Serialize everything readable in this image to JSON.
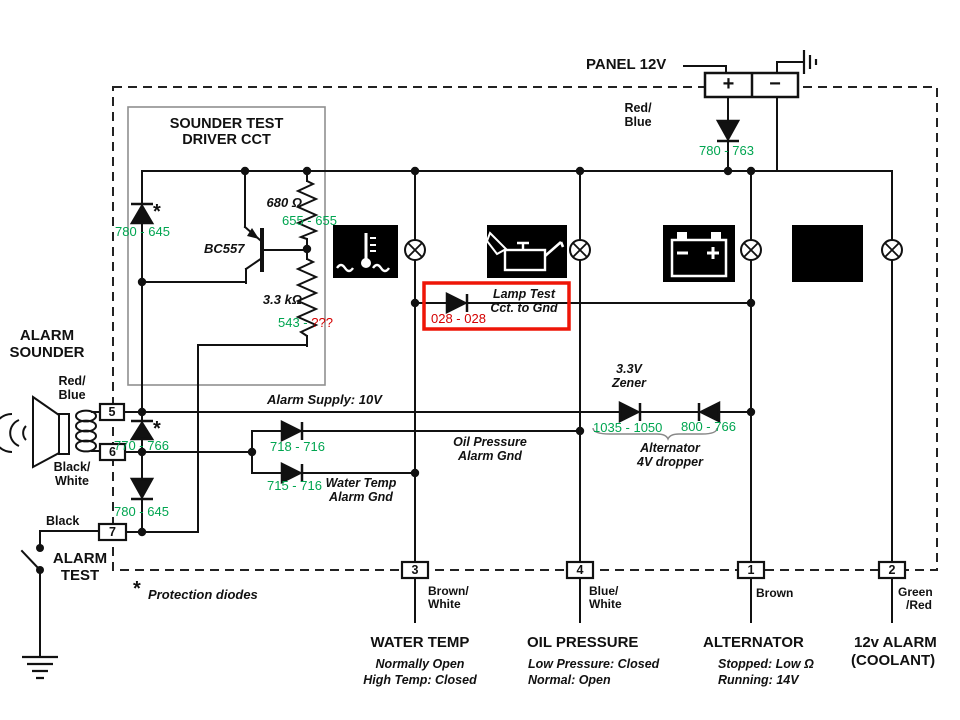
{
  "colors": {
    "annotation_green": "#00a550",
    "annotation_red": "#d40000",
    "highlight_red": "#ee1507",
    "wire_black": "#111111"
  },
  "panel": {
    "title": "PANEL 12V",
    "plus": "+",
    "minus": "−",
    "wire_color_1": "Red/",
    "wire_color_2": "Blue"
  },
  "sounder_test_box": {
    "title_1": "SOUNDER TEST",
    "title_2": "DRIVER CCT",
    "resistor_top": "680 Ω",
    "resistor_bottom": "3.3 kΩ",
    "transistor": "BC557",
    "protection_star": "*"
  },
  "alarm_sounder": {
    "title_1": "ALARM",
    "title_2": "SOUNDER",
    "wire_top_1": "Red/",
    "wire_top_2": "Blue",
    "wire_bottom_1": "Black/",
    "wire_bottom_2": "White"
  },
  "alarm_test": {
    "wire_color": "Black",
    "label_1": "ALARM",
    "label_2": "TEST"
  },
  "footnote": {
    "star": "*",
    "text": "Protection diodes"
  },
  "net_labels": {
    "alarm_supply": "Alarm Supply: 10V",
    "oil_pressure_gnd_1": "Oil Pressure",
    "oil_pressure_gnd_2": "Alarm Gnd",
    "water_temp_gnd_1": "Water Temp",
    "water_temp_gnd_2": "Alarm Gnd",
    "zener_1": "3.3V",
    "zener_2": "Zener",
    "dropper_1": "Alternator",
    "dropper_2": "4V dropper",
    "lamp_test_1": "Lamp Test",
    "lamp_test_2": "Cct. to Gnd"
  },
  "measurements": {
    "sounder_diode": "780 - 645",
    "resistor_680": "655 - 655",
    "resistor_33k": "543 - ",
    "resistor_33k_unknown": "???",
    "panel_diode": "780 - 763",
    "lamp_test_diode": "028 - 028",
    "pin5_diode": "770 - 766",
    "oil_gnd_diode": "718 - 716",
    "water_gnd_diode": "715 - 716",
    "pin7_diode": "780 - 645",
    "zener_forward": "1035 - 1050",
    "zener_reverse": "800 - 766"
  },
  "connector_pins": {
    "pin5": "5",
    "pin6": "6",
    "pin7": "7",
    "pin3": "3",
    "pin4": "4",
    "pin1": "1",
    "pin2": "2"
  },
  "wire_colors": {
    "pin3_1": "Brown/",
    "pin3_2": "White",
    "pin4_1": "Blue/",
    "pin4_2": "White",
    "pin1": "Brown",
    "pin2_1": "Green",
    "pin2_2": "/Red"
  },
  "senders": {
    "water_temp": {
      "title": "WATER TEMP",
      "note_1": "Normally Open",
      "note_2": "High Temp: Closed"
    },
    "oil_pressure": {
      "title": "OIL PRESSURE",
      "note_1": "Low Pressure: Closed",
      "note_2": "Normal: Open"
    },
    "alternator": {
      "title": "ALTERNATOR",
      "note_1": "Stopped: Low Ω",
      "note_2": "Running: 14V"
    },
    "coolant_alarm": {
      "title": "12v ALARM",
      "subtitle": "(COOLANT)"
    }
  }
}
